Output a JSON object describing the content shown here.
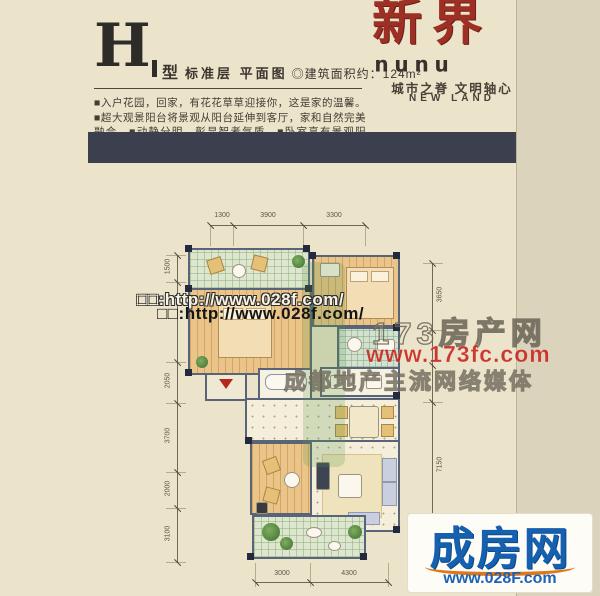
{
  "header": {
    "plan_letter": "H",
    "type_label": "型",
    "title": "标准层  平面图",
    "area": "◎建筑面积约：124m²",
    "description": "■入户花园，回家，有花花草草迎接你，这是家的温馨。■超大观景阳台将景观从阳台延伸到客厅，家和自然完美融合。■动静分明，彰显智者气质。■卧室享有景观阳台。■书房与大景观阳台相连，诗意栖居生活之所。"
  },
  "brand": {
    "logo_cn": "新界",
    "logo_en": "nunu",
    "slogan": "城市之脊  文明轴心",
    "slogan_en": "NEW LAND"
  },
  "floor_plan": {
    "dimensions_top": [
      "1300",
      "3900",
      "3300"
    ],
    "dimensions_left": [
      "1500",
      "2050",
      "3700",
      "2000",
      "3100"
    ],
    "dimensions_right": [
      "3650",
      "7150"
    ],
    "dimensions_bottom": [
      "3000",
      "4300"
    ]
  },
  "watermarks": {
    "url_outline": "□□:http://www.028f.com/",
    "url_solid": "□□:http://www.028f.com/",
    "portal_name": "173房产网",
    "portal_url": "www.173fc.com",
    "portal_slogan": "成都地产主流网络媒体"
  },
  "footer_logo": {
    "name": "成房网",
    "url": "www.028F.com"
  },
  "colors": {
    "background_beige": "#ece3cb",
    "bar_navy": "#3c3f4e",
    "brand_red": "#9e2f24",
    "watermark_red": "#c42018",
    "footer_blue": "#1660b0",
    "footer_orange": "#e07818"
  }
}
